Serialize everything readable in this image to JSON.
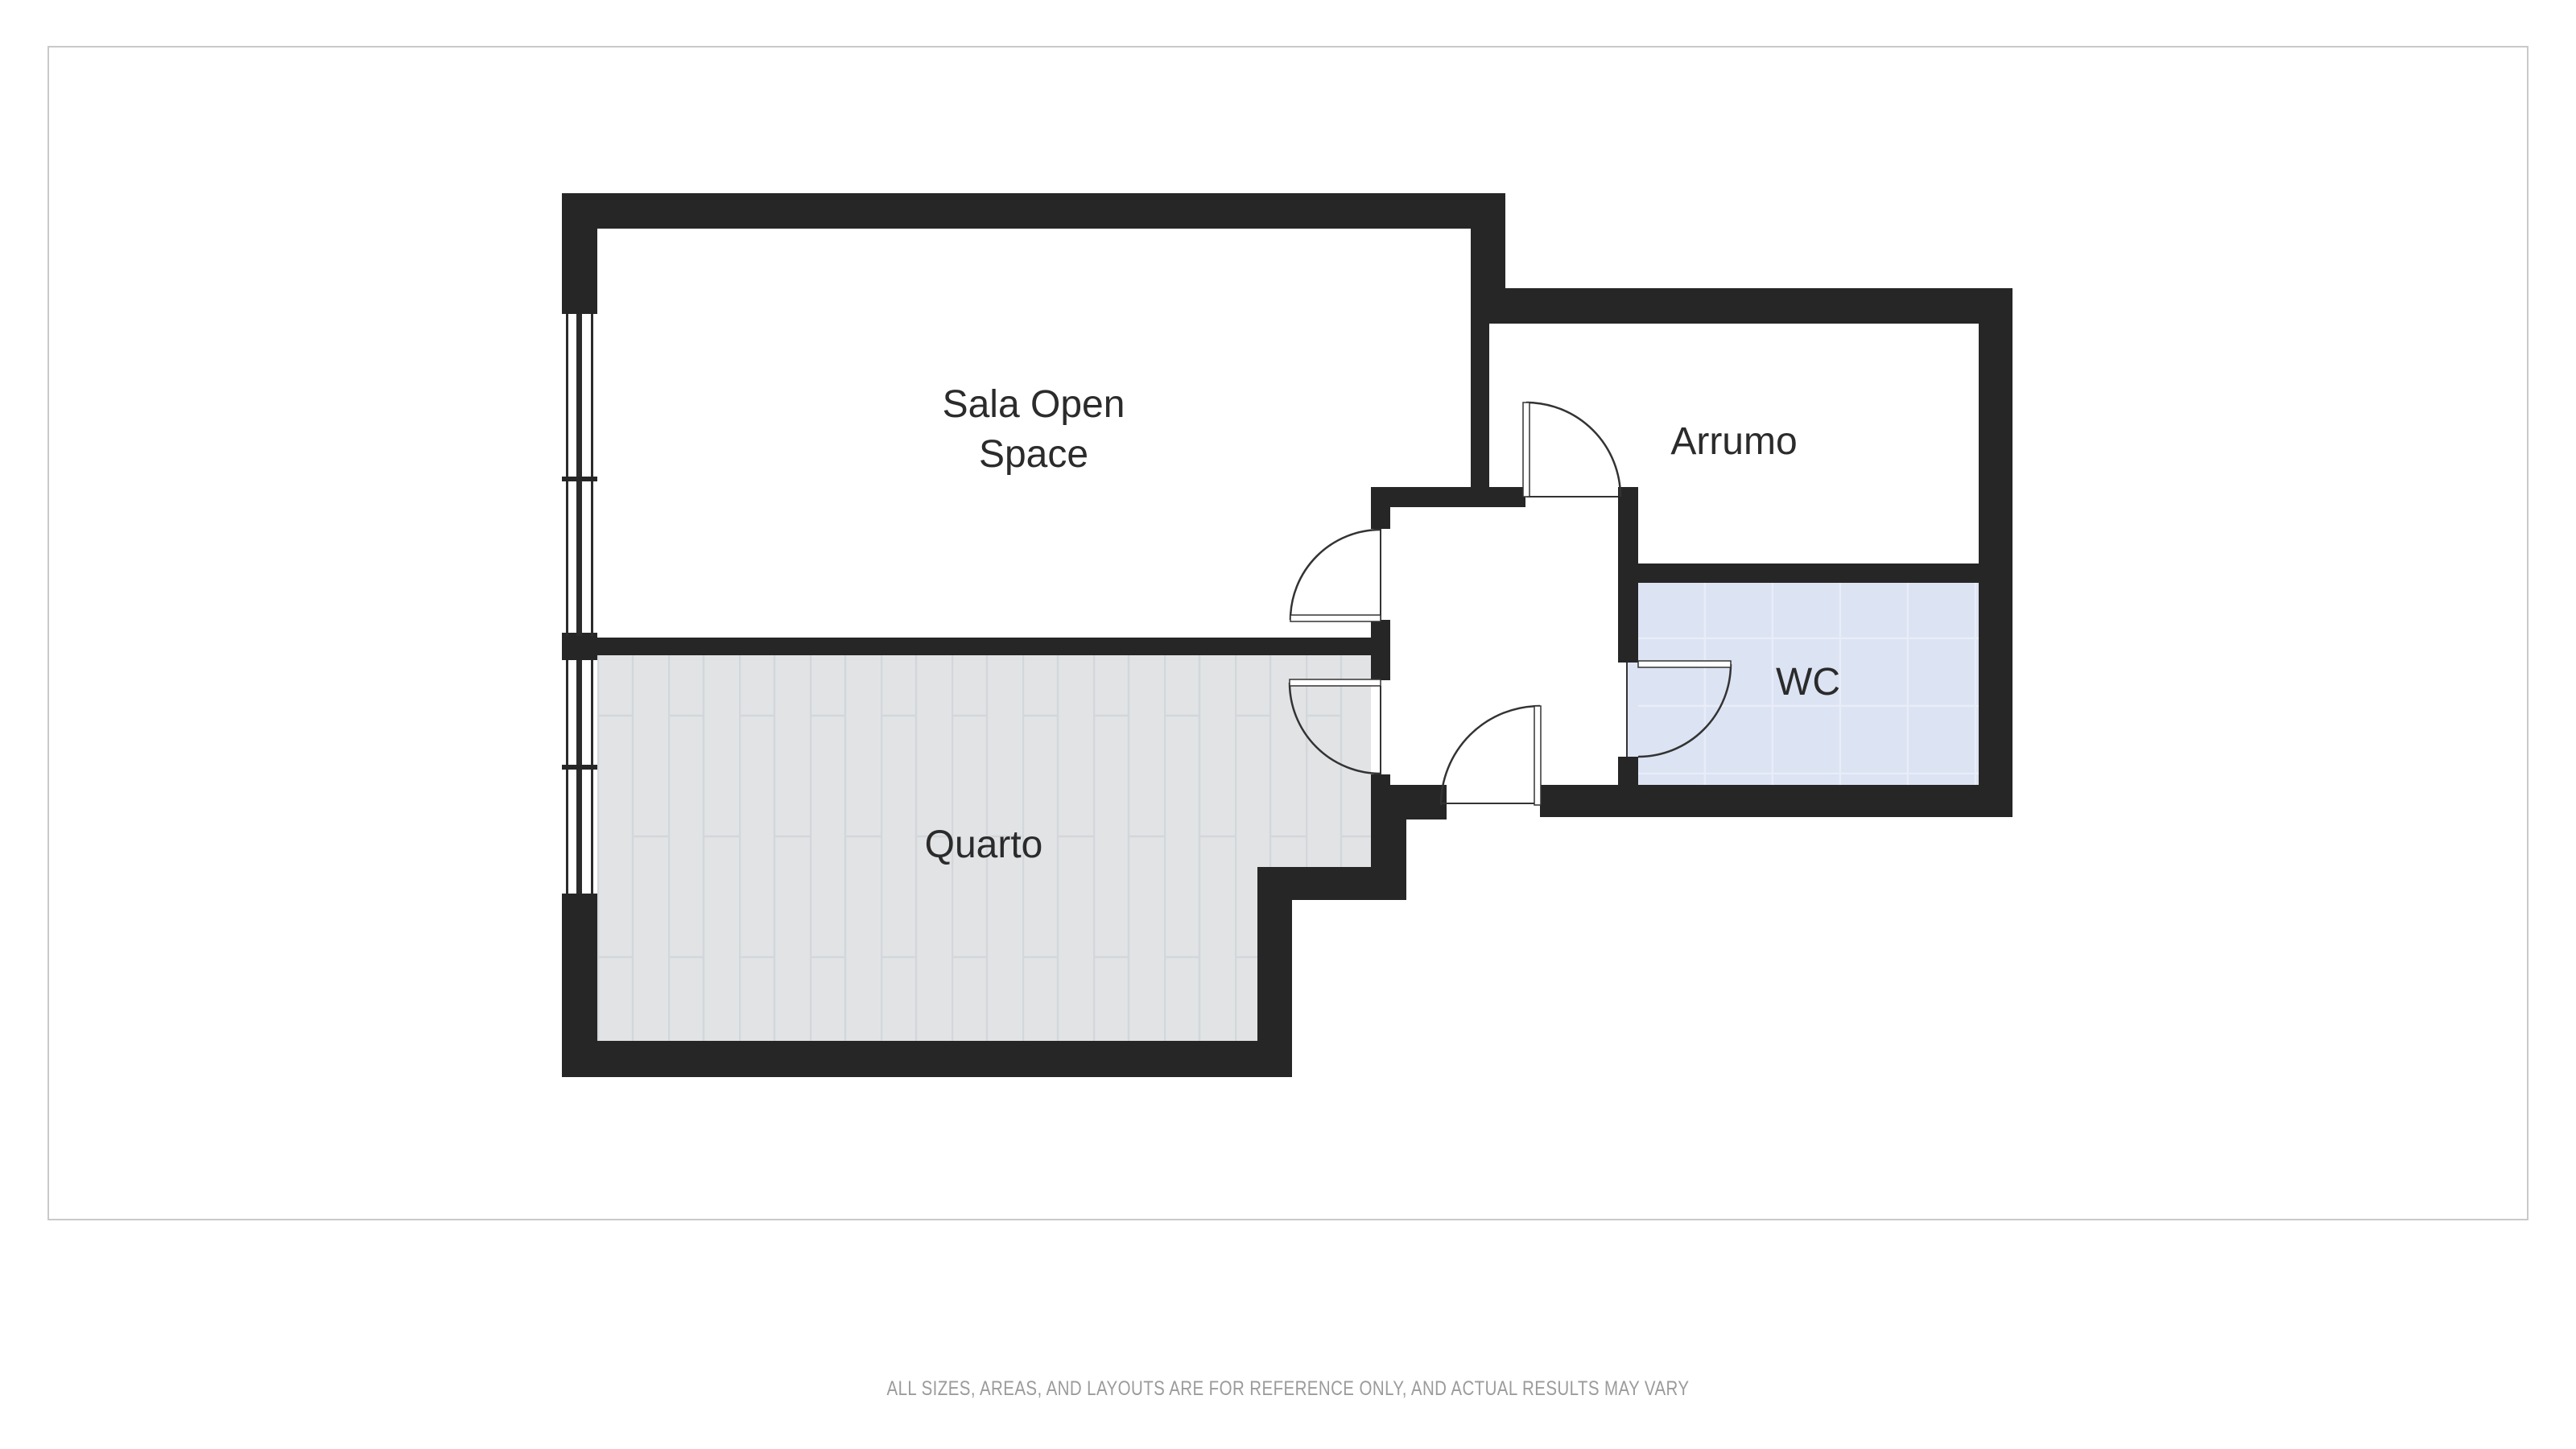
{
  "floor_plan": {
    "rooms": {
      "sala": {
        "label_line1": "Sala Open",
        "label_line2": "Space"
      },
      "arrumo": {
        "label": "Arrumo"
      },
      "wc": {
        "label": "WC",
        "fill": "#dce3f3",
        "grid_line_color": "#e9edf8"
      },
      "quarto": {
        "label": "Quarto",
        "fill": "#e2e3e5",
        "plank_line_color": "#d2d7dc"
      }
    },
    "colors": {
      "wall": "#262626",
      "door_line": "#333333",
      "frame_border": "#c9c9c9",
      "label_text": "#2b2b2b"
    }
  },
  "disclaimer": {
    "text": "ALL SIZES, AREAS, AND LAYOUTS ARE FOR REFERENCE ONLY, AND ACTUAL RESULTS MAY VARY",
    "color": "#9b9b9b"
  }
}
